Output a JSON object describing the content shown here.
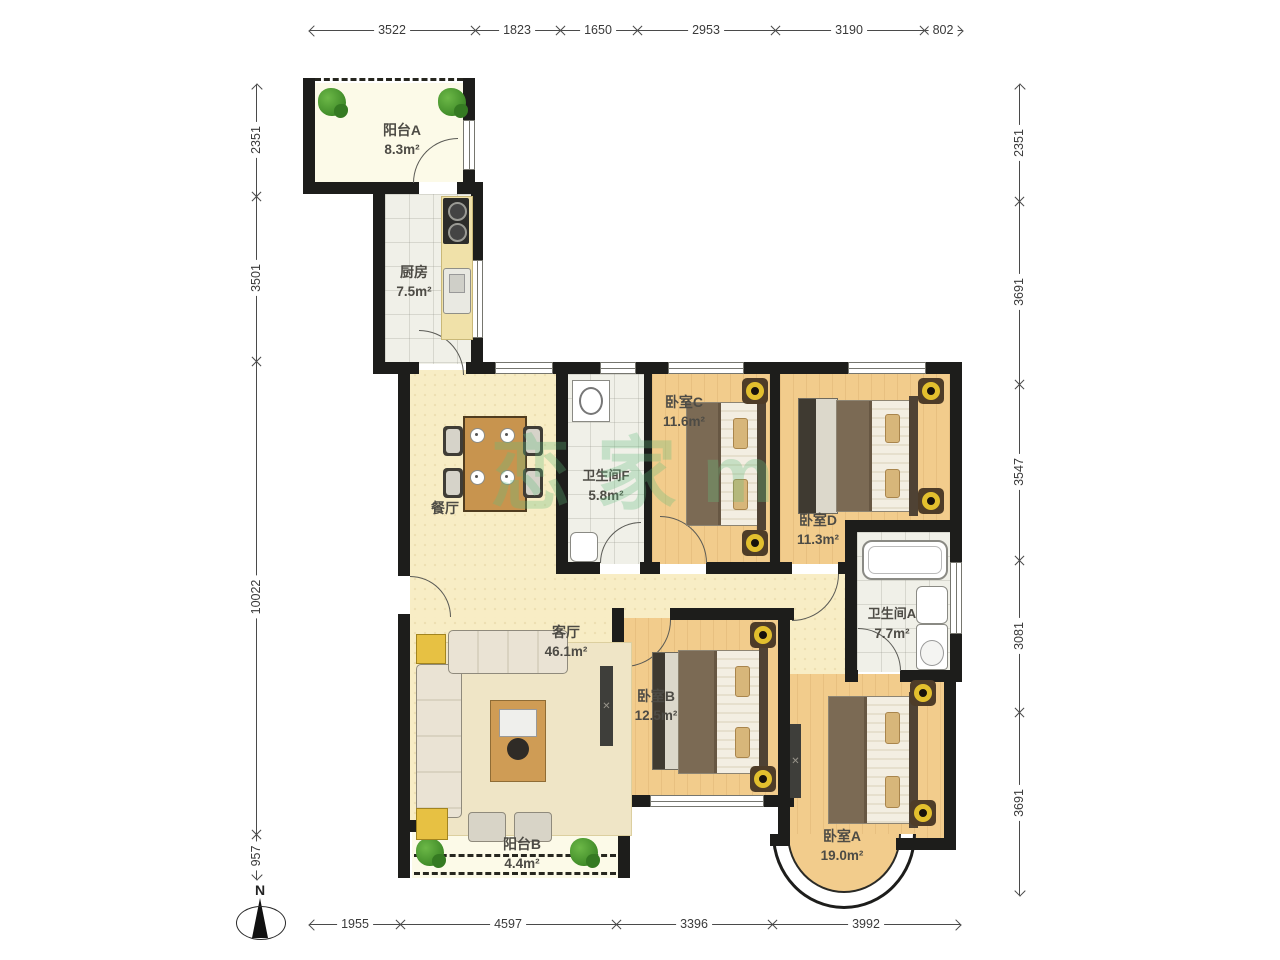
{
  "dims": {
    "top": [
      "3522",
      "1823",
      "1650",
      "2953",
      "3190",
      "802"
    ],
    "left": [
      "2351",
      "3501",
      "10022",
      "957"
    ],
    "right": [
      "2351",
      "3691",
      "3547",
      "3081",
      "3691"
    ],
    "bottom": [
      "1955",
      "4597",
      "3396",
      "3992"
    ]
  },
  "rooms": {
    "balcony_a": {
      "name": "阳台A",
      "area": "8.3m²"
    },
    "kitchen": {
      "name": "厨房",
      "area": "7.5m²"
    },
    "dining": {
      "name": "餐厅"
    },
    "bath_f": {
      "name": "卫生间F",
      "area": "5.8m²"
    },
    "bed_c": {
      "name": "卧室C",
      "area": "11.6m²"
    },
    "bed_d": {
      "name": "卧室D",
      "area": "11.3m²"
    },
    "bath_a": {
      "name": "卫生间A",
      "area": "7.7m²"
    },
    "living": {
      "name": "客厅",
      "area": "46.1m²"
    },
    "bed_b": {
      "name": "卧室B",
      "area": "12.5m²"
    },
    "bed_a": {
      "name": "卧室A",
      "area": "19.0m²"
    },
    "balcony_b": {
      "name": "阳台B",
      "area": "4.4m²"
    }
  },
  "compass": {
    "label": "N"
  },
  "watermark": {
    "text": "恋家m"
  },
  "colors": {
    "wall": "#1d1d1b",
    "wood_floor": "#f2cc8c",
    "open_floor": "#f8edc5",
    "tile_floor": "#f0f0e8",
    "plant": "#3f8a28",
    "nightstand_ring": "#e2bf2e"
  }
}
